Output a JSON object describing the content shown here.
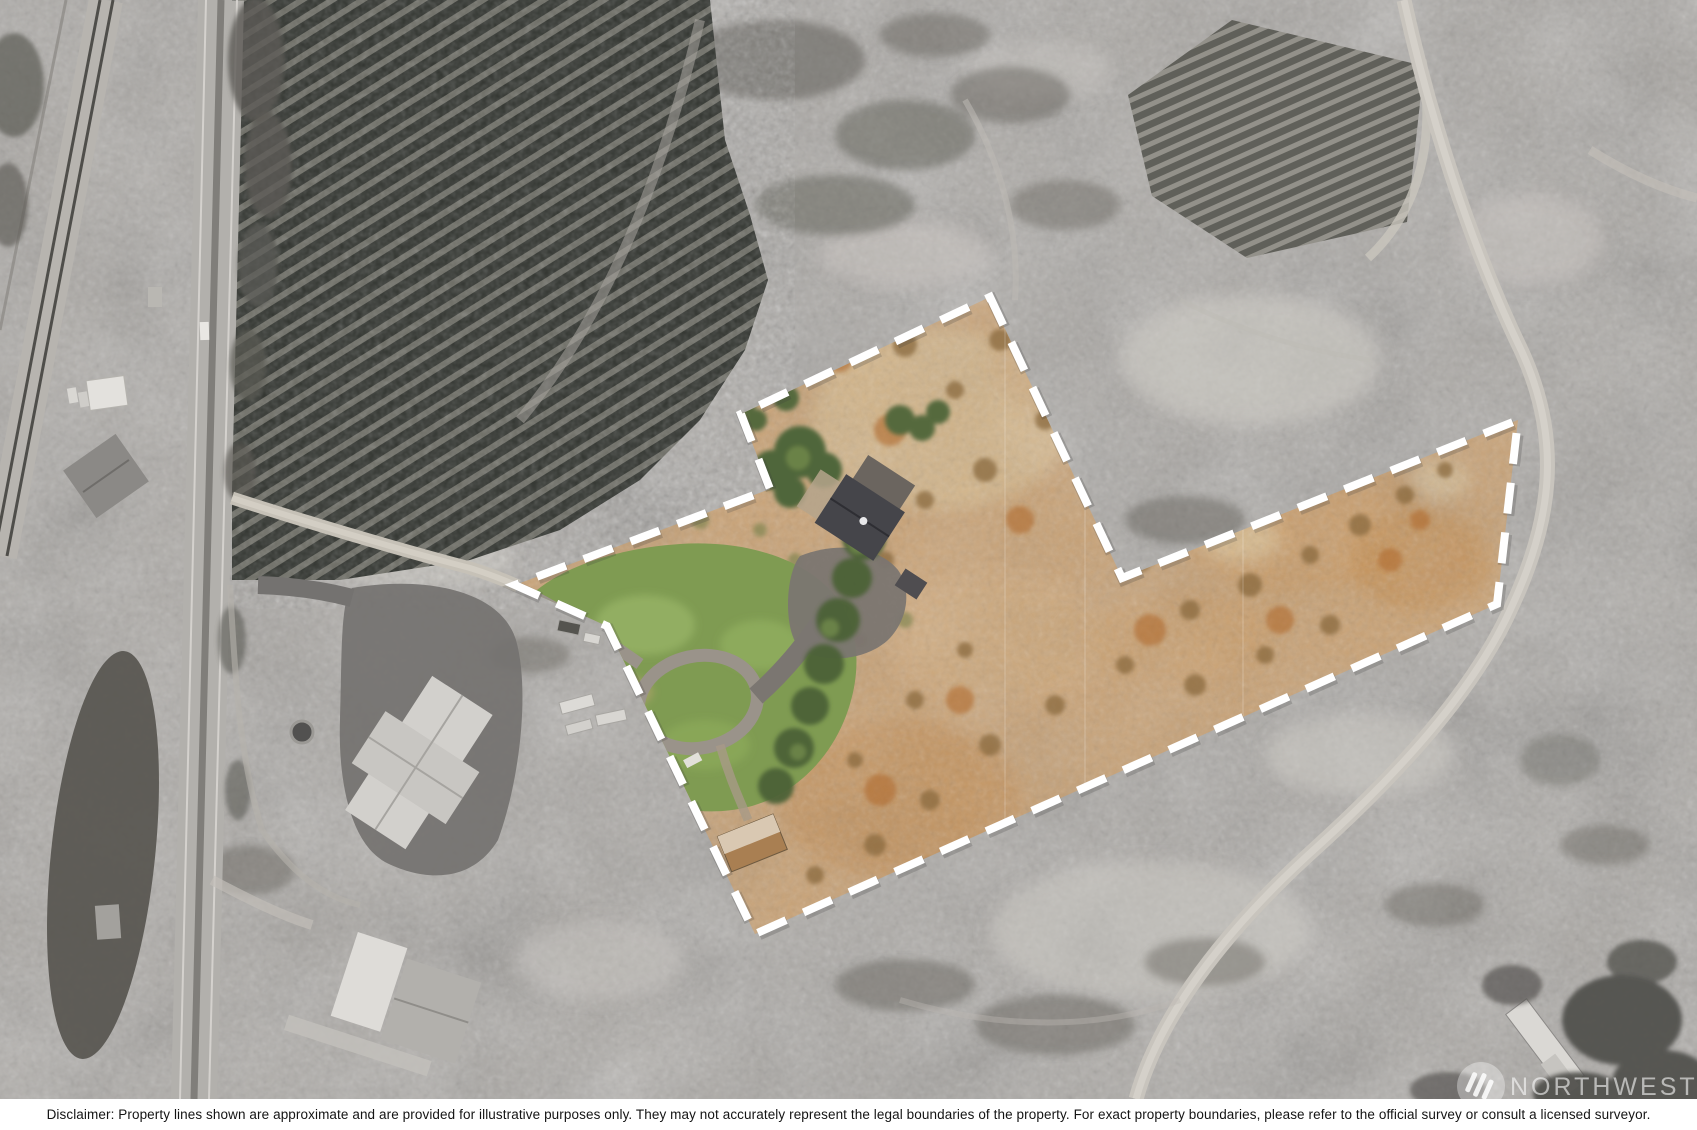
{
  "image": {
    "kind": "real-estate aerial drone photo with highlighted parcel",
    "width_px": 1697,
    "height_px": 1130
  },
  "boundary": {
    "svg_points": "990,297 1122,578 1518,420 1497,604 755,934 607,626 515,585 770,489 741,414",
    "stroke_color": "#ffffff",
    "style": "dashed",
    "dash_on": 31,
    "dash_off": 19,
    "stroke_width": 8
  },
  "palette": {
    "surroundings_gray": "#aba8a4",
    "orchard_dark": "#31342f",
    "parcel_tan": "#c9a173",
    "parcel_orange_scrub": "#b06a30",
    "lawn_green": "#7f9b52",
    "tree_green": "#4c6136",
    "main_roof_gray": "#45454a",
    "road_light": "#c8c4bd",
    "asphalt_dark": "#747270"
  },
  "watermark": {
    "logo": "three-diagonal-bars-circle",
    "text": "NORTHWEST"
  },
  "disclaimer": {
    "text": "Disclaimer: Property lines shown are approximate and are provided for illustrative purposes only. They may not accurately represent the legal boundaries of the property. For exact property boundaries, please refer to the official survey or consult a licensed surveyor."
  },
  "scene": {
    "grayscale_features": [
      "railroad tracks upper-left",
      "highway running top to bottom on left",
      "dark evergreen orchard block upper-left",
      "small orchard block upper-right with dirt road",
      "neighbor farmhouse with light cross-gable roof and dark asphalt yard",
      "second neighbor house lower-left",
      "dark tilled field along lower-left",
      "winding dirt road on right side",
      "trees and white trailer lower-right under watermark"
    ],
    "parcel_features": [
      "tan and orange scrubland",
      "green lawn with oval loop driveway",
      "dark-roofed main house with trees",
      "tan-roofed shed near south corner",
      "tree row along driveway"
    ]
  }
}
